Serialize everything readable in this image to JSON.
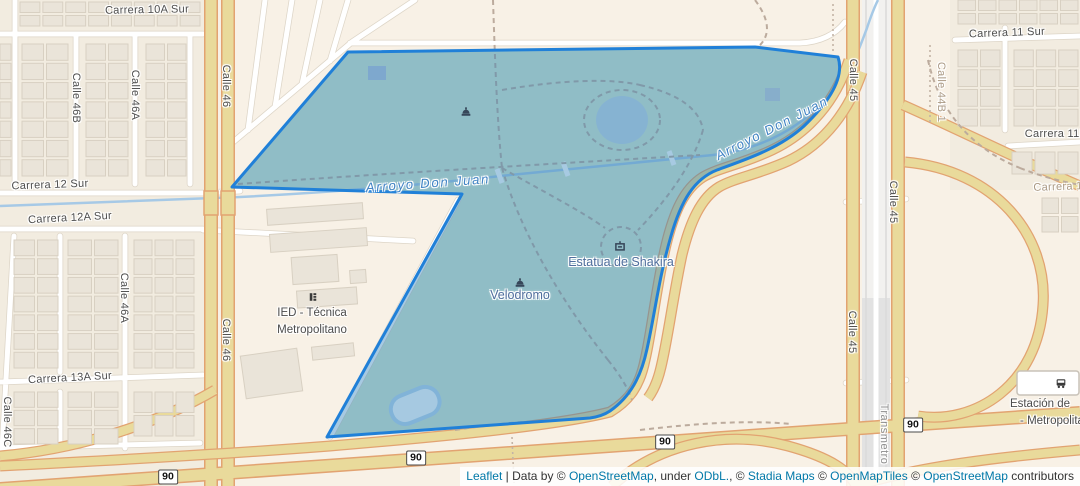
{
  "map": {
    "colors": {
      "land": "#f8f1e6",
      "park_base": "#d8e9cf",
      "highlight_overlay": "rgba(45,128,185,0.42)",
      "highlight_stroke": "#2080d8",
      "road_fill": "#e9da9b",
      "road_casing": "#e2a371",
      "water": "#a6c9e6",
      "link": "#0078a8"
    },
    "labels": [
      {
        "name": "street-label-carrera-10a-sur",
        "type": "street",
        "text": "Carrera 10A Sur",
        "x": 147,
        "y": 10,
        "rot": -1
      },
      {
        "name": "street-label-carrera-12-sur",
        "type": "street",
        "text": "Carrera 12 Sur",
        "x": 50,
        "y": 185,
        "rot": -2
      },
      {
        "name": "street-label-carrera-12a-sur",
        "type": "street",
        "text": "Carrera 12A Sur",
        "x": 70,
        "y": 218,
        "rot": -3
      },
      {
        "name": "street-label-carrera-13a-sur",
        "type": "street",
        "text": "Carrera 13A Sur",
        "x": 70,
        "y": 378,
        "rot": -3
      },
      {
        "name": "street-label-carrera-11-sur",
        "type": "street",
        "text": "Carrera 11 Sur",
        "x": 1007,
        "y": 33,
        "rot": -2
      },
      {
        "name": "street-label-carrera-11b",
        "type": "street",
        "text": "Carrera 11B",
        "x": 1056,
        "y": 134,
        "rot": 0
      },
      {
        "name": "street-label-calle-46b",
        "type": "street",
        "text": "Calle 46B",
        "x": 76,
        "y": 98,
        "rot": 90
      },
      {
        "name": "street-label-calle-46a-north",
        "type": "street",
        "text": "Calle 46A",
        "x": 135,
        "y": 95,
        "rot": 90
      },
      {
        "name": "street-label-calle-46-north",
        "type": "street",
        "text": "Calle 46",
        "x": 226,
        "y": 86,
        "rot": 90
      },
      {
        "name": "street-label-calle-46-south",
        "type": "street",
        "text": "Calle 46",
        "x": 226,
        "y": 340,
        "rot": 90
      },
      {
        "name": "street-label-calle-46a-south",
        "type": "street",
        "text": "Calle 46A",
        "x": 124,
        "y": 298,
        "rot": 90
      },
      {
        "name": "street-label-calle-46c",
        "type": "street",
        "text": "Calle 46C",
        "x": 7,
        "y": 422,
        "rot": 90
      },
      {
        "name": "street-label-calle-45-north",
        "type": "street",
        "text": "Calle 45",
        "x": 853,
        "y": 80,
        "rot": 90
      },
      {
        "name": "street-label-calle-45-mid",
        "type": "street",
        "text": "Calle 45",
        "x": 893,
        "y": 202,
        "rot": 90
      },
      {
        "name": "street-label-calle-45-south",
        "type": "street",
        "text": "Calle 45",
        "x": 852,
        "y": 332,
        "rot": 90
      },
      {
        "name": "transit-label-transmetro",
        "type": "transit",
        "text": "Transmetro",
        "x": 884,
        "y": 434,
        "rot": 90
      },
      {
        "name": "path-label-calle-44b-1",
        "type": "path",
        "text": "Calle 44B 1",
        "x": 941,
        "y": 92,
        "rot": 90
      },
      {
        "name": "path-label-carrera-1",
        "type": "path",
        "text": "Carrera 1",
        "x": 1058,
        "y": 187,
        "rot": -2
      },
      {
        "name": "water-label-arroyo-don-juan-west",
        "type": "water",
        "text": "Arroyo Don Juan",
        "x": 428,
        "y": 183,
        "rot": -4
      },
      {
        "name": "water-label-arroyo-don-juan-east",
        "type": "water",
        "text": "Arroyo Don Juan",
        "x": 772,
        "y": 128,
        "rot": -27
      },
      {
        "name": "poi-label-velodromo",
        "type": "poiblue",
        "text": "Velodromo",
        "x": 520,
        "y": 295,
        "rot": 0
      },
      {
        "name": "poi-label-estatua-de-shakira",
        "type": "poiblue",
        "text": "Estatua de Shakira",
        "x": 621,
        "y": 262,
        "rot": 0
      },
      {
        "name": "poi-label-ied-line1",
        "type": "poigray",
        "text": "IED - Técnica",
        "x": 312,
        "y": 313,
        "rot": 0
      },
      {
        "name": "poi-label-ied-line2",
        "type": "poigray",
        "text": "Metropolitano",
        "x": 312,
        "y": 330,
        "rot": 0
      },
      {
        "name": "poi-label-estacion-line1",
        "type": "poigray",
        "text": "Estación de",
        "x": 1040,
        "y": 404,
        "rot": 0
      },
      {
        "name": "poi-label-estacion-line2",
        "type": "poigray",
        "text": "- Metropolita",
        "x": 1052,
        "y": 421,
        "rot": 0
      }
    ],
    "shields": [
      {
        "name": "route-shield-90-west",
        "text": "90",
        "x": 168,
        "y": 477
      },
      {
        "name": "route-shield-90-midwest",
        "text": "90",
        "x": 416,
        "y": 458
      },
      {
        "name": "route-shield-90-mideast",
        "text": "90",
        "x": 665,
        "y": 442
      },
      {
        "name": "route-shield-90-east",
        "text": "90",
        "x": 913,
        "y": 425
      }
    ],
    "icons": [
      {
        "name": "park-poi-icon",
        "kind": "dome",
        "x": 466,
        "y": 111
      },
      {
        "name": "velodrome-icon",
        "kind": "dome",
        "x": 520,
        "y": 282
      },
      {
        "name": "statue-icon",
        "kind": "artwork",
        "x": 620,
        "y": 246
      },
      {
        "name": "school-icon",
        "kind": "school",
        "x": 313,
        "y": 297
      },
      {
        "name": "bus-station-icon",
        "kind": "bus",
        "x": 1061,
        "y": 383
      }
    ]
  },
  "attribution": {
    "parts": [
      {
        "text": "Leaflet",
        "link": true
      },
      {
        "text": " | Data by © ",
        "link": false
      },
      {
        "text": "OpenStreetMap",
        "link": true
      },
      {
        "text": ", under ",
        "link": false
      },
      {
        "text": "ODbL.",
        "link": true
      },
      {
        "text": ", © ",
        "link": false
      },
      {
        "text": "Stadia Maps",
        "link": true
      },
      {
        "text": " © ",
        "link": false
      },
      {
        "text": "OpenMapTiles",
        "link": true
      },
      {
        "text": " © ",
        "link": false
      },
      {
        "text": "OpenStreetMap",
        "link": true
      },
      {
        "text": " contributors",
        "link": false
      }
    ]
  }
}
